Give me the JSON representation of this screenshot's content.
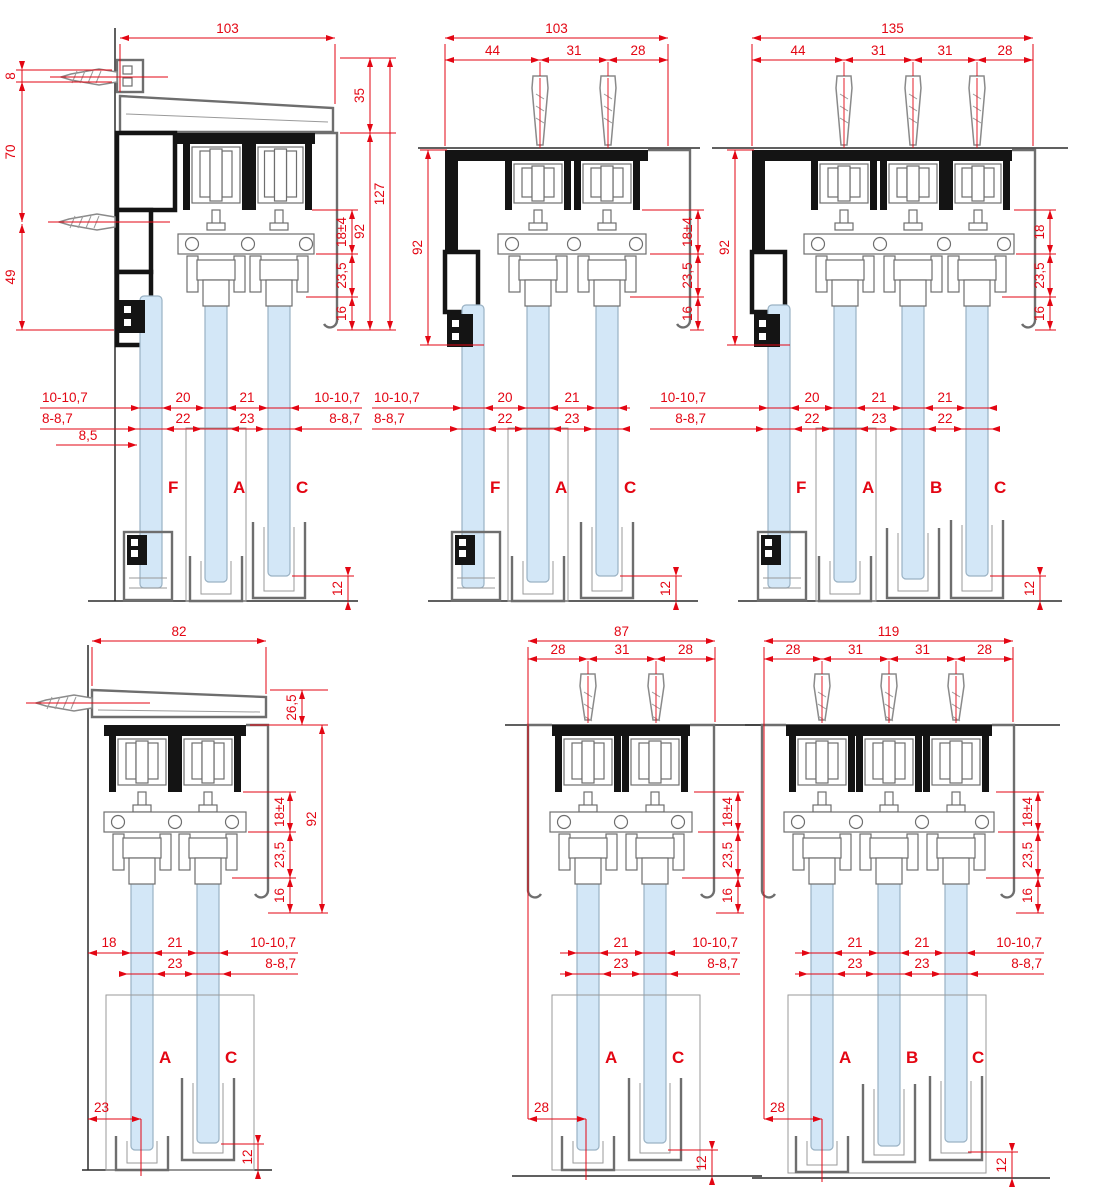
{
  "page": {
    "title": "Sliding glass system cross-section drawings"
  },
  "colors": {
    "dimension_red": "#e30613",
    "glass_blue": "#d3e7f7",
    "profile_black": "#141414",
    "profile_gray": "#6e6e6e",
    "background": "#ffffff"
  },
  "diagrams": [
    {
      "id": "top-left",
      "glass_labels": [
        "F",
        "A",
        "C"
      ],
      "total_width": "103",
      "left_dims": [
        "8",
        "70",
        "49"
      ],
      "right_outer_dims": [
        "35",
        "92",
        "127"
      ],
      "right_inner_dims": [
        "18±4",
        "23,5",
        "16"
      ],
      "gap_row_top": [
        "10-10,7",
        "20",
        "21",
        "10-10,7"
      ],
      "gap_row_bottom": [
        "8-8,7",
        "22",
        "23",
        "8-8,7"
      ],
      "wall_gap": "8,5",
      "floor_clearance": "12"
    },
    {
      "id": "top-middle",
      "glass_labels": [
        "F",
        "A",
        "C"
      ],
      "total_width": "103",
      "segments": [
        "44",
        "31",
        "28"
      ],
      "left_dims": [
        "92"
      ],
      "right_inner_dims": [
        "18±4",
        "23,5",
        "16"
      ],
      "gap_row_top": [
        "10-10,7",
        "20",
        "21"
      ],
      "gap_row_bottom": [
        "8-8,7",
        "22",
        "23"
      ],
      "floor_clearance": "12"
    },
    {
      "id": "top-right",
      "glass_labels": [
        "F",
        "A",
        "B",
        "C"
      ],
      "total_width": "135",
      "segments": [
        "44",
        "31",
        "31",
        "28"
      ],
      "left_dims": [
        "92"
      ],
      "right_inner_dims": [
        "18",
        "23,5",
        "16"
      ],
      "gap_row_top": [
        "10-10,7",
        "20",
        "21",
        "21"
      ],
      "gap_row_bottom": [
        "8-8,7",
        "22",
        "23",
        "22"
      ],
      "floor_clearance": "12"
    },
    {
      "id": "bottom-left",
      "glass_labels": [
        "A",
        "C"
      ],
      "total_width": "82",
      "right_outer_dims": [
        "26,5",
        "92"
      ],
      "right_inner_dims": [
        "18±4",
        "23,5",
        "16"
      ],
      "gap_row_top": [
        "18",
        "21",
        "10-10,7"
      ],
      "gap_row_bottom": [
        "23",
        "8-8,7"
      ],
      "bottom_offset": "23",
      "floor_clearance": "12"
    },
    {
      "id": "bottom-middle",
      "glass_labels": [
        "A",
        "C"
      ],
      "total_width": "87",
      "segments": [
        "28",
        "31",
        "28"
      ],
      "right_inner_dims": [
        "18±4",
        "23,5",
        "16"
      ],
      "gap_row_top": [
        "21",
        "10-10,7"
      ],
      "gap_row_bottom": [
        "23",
        "8-8,7"
      ],
      "bottom_offset": "28",
      "floor_clearance": "12"
    },
    {
      "id": "bottom-right",
      "glass_labels": [
        "A",
        "B",
        "C"
      ],
      "total_width": "119",
      "segments": [
        "28",
        "31",
        "31",
        "28"
      ],
      "right_inner_dims": [
        "18±4",
        "23,5",
        "16"
      ],
      "gap_row_top": [
        "21",
        "21",
        "10-10,7"
      ],
      "gap_row_bottom": [
        "23",
        "23",
        "8-8,7"
      ],
      "bottom_offset": "28",
      "floor_clearance": "12"
    }
  ]
}
